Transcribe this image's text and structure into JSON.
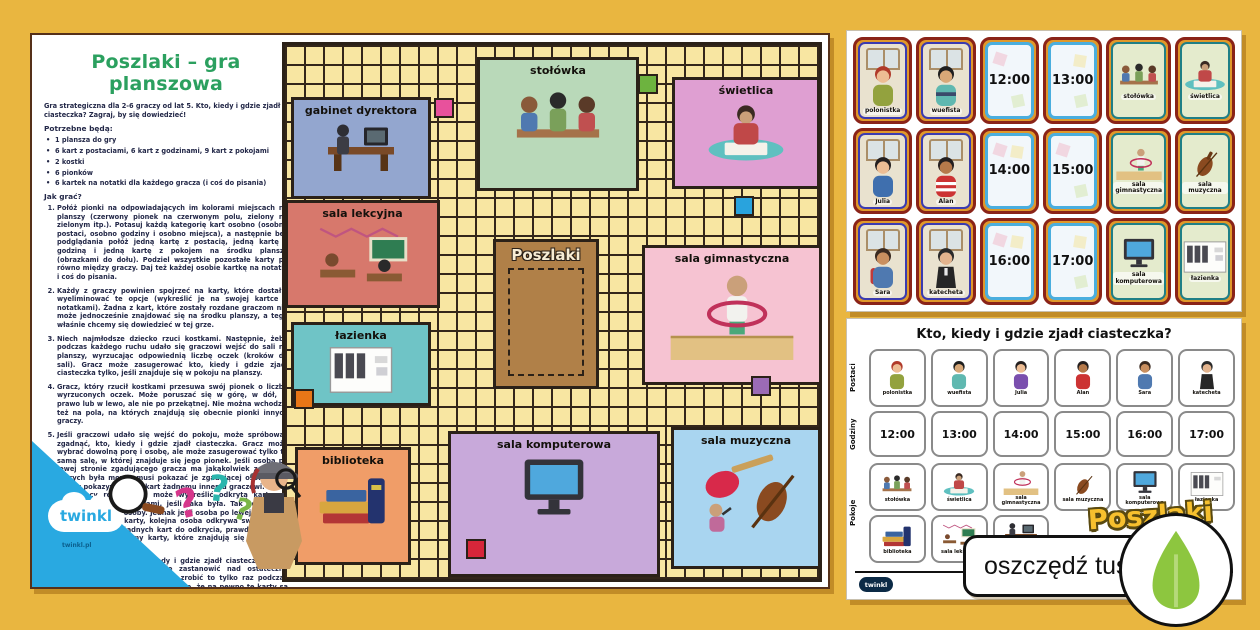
{
  "background_color": "#e9b640",
  "brand": {
    "logo": "twinkl",
    "site": "twinkl.pl"
  },
  "instructions": {
    "title": "Poszlaki – gra planszowa",
    "title_color": "#2ba05f",
    "intro": "Gra strategiczna dla 2-6 graczy od lat 5. Kto, kiedy i gdzie zjadł ciasteczka? Zagraj, by się dowiedzieć!",
    "needed_heading": "Potrzebne będą:",
    "needed_items": [
      "1 plansza do gry",
      "6 kart z postaciami, 6 kart z godzinami, 9 kart z pokojami",
      "2 kostki",
      "6 pionków",
      "6 kartek na notatki dla każdego gracza (i coś do pisania)"
    ],
    "howto_heading": "Jak grać?",
    "steps": [
      "Połóż pionki na odpowiadających im kolorami miejscach na planszy (czerwony pionek na czerwonym polu, zielony na zielonym itp.). Potasuj każdą kategorię kart osobno (osobno postaci, osobno godziny i osobno miejsca), a następnie bez podglądania połóż jedną kartę z postacią, jedną kartę z godziną i jedną kartę z pokojem na środku planszy (obrazkami do dołu). Podziel wszystkie pozostałe karty po równo między graczy. Daj też każdej osobie kartkę na notatki i coś do pisania.",
      "Każdy z graczy powinien spojrzeć na karty, które dostał i wyeliminować te opcje (wykreślić je na swojej kartce z notatkami). Żadna z kart, które zostały rozdane graczom nie może jednocześnie znajdować się na środku planszy, a tego właśnie chcemy się dowiedzieć w tej grze.",
      "Niech najmłodsze dziecko rzuci kostkami. Następnie, żeby podczas każdego ruchu udało się graczowi wejść do sali na planszy, wyrzucając odpowiednią liczbę oczek (kroków do sali). Gracz może zasugerować kto, kiedy i gdzie zjadł ciasteczka tylko, jeśli znajduje się w pokoju na planszy.",
      "Gracz, który rzucił kostkami przesuwa swój pionek o liczbę wyrzuconych oczek. Może poruszać się w górę, w dół, w prawo lub w lewo, ale nie po przekątnej. Nie można wchodzić też na pola, na których znajdują się obecnie pionki innych graczy.",
      "Jeśli graczowi udało się wejść do pokoju, może spróbować zgadnąć, kto, kiedy i gdzie zjadł ciasteczka. Gracz może wybrać dowolną porę i osobę, ale może zasugerować tylko tę samą salę, w której znajduje się jego pionek. Jeśli osoba po lewej stronie zgadującego gracza ma jakąkolwiek z kart, o których była mowa, musi pokazać je zgadującej osobie. Nie należy pokazywać tych kart żadnemu innemu graczowi. Gracz sugerujący rozwiązanie może wykreślić odkrytą kartę na swojej kartce z notatkami, jeśli taka była. Tak kończy się kolejka pierwszej osoby. Jednak jeśli osoba po lewej nie miała żadnej pasującej karty, kolejna osoba odkrywa swoje karty. Jeśli nikt nie ma żadnych kart do odkrycia, prawdopodobnie poprawnie odgadliśmy karty, które znajdują się na środku planszy.",
      "Można sugerować, kto, kiedy i gdzie zjadł ciasteczka wiele razy, ale trzeba bardzo się zastanowić nad ostateczną zagadką (oskarżeniem). Można zrobić to tylko raz podczas całej rozgrywki. Należy upewnić się, że na pewno te karty są na środku planszy, bez zgadywania. Jeśli ktoś zdecyduje się na wysunięcie ostatecznego oskarżenia, sprawdza on karty na środku planszy w taki sposób, żeby nikt inny nie mógł ich podejrzeć. Jeśli wszystkie trzy karty zgadzają się z oskarżeniem, mamy zwycięzcę! Jednak jeśli nie udało się zgadnąć choć jednej karty, niestety tym razem nie udało nam się wygrać i nie wolno nam już kontynuować gry. Reszta graczy kontynuuje grę."
    ]
  },
  "board": {
    "center_label": "Poszlaki",
    "rooms": [
      {
        "label": "gabinet dyrektora",
        "color": "#93a6cf"
      },
      {
        "label": "stołówka",
        "color": "#b9d9b9"
      },
      {
        "label": "świetlica",
        "color": "#df9fd2"
      },
      {
        "label": "sala lekcyjna",
        "color": "#d7786c"
      },
      {
        "label": "sala gimnastyczna",
        "color": "#f6c3d2"
      },
      {
        "label": "łazienka",
        "color": "#6fc4c6"
      },
      {
        "label": "biblioteka",
        "color": "#f09d68"
      },
      {
        "label": "sala komputerowa",
        "color": "#c8a9da"
      },
      {
        "label": "sala muzyczna",
        "color": "#a9d5f0"
      }
    ],
    "start_colors": [
      "#e8519c",
      "#6db33f",
      "#29a3dd",
      "#9b6bb5",
      "#e87617",
      "#d7263a"
    ]
  },
  "cards": {
    "rows": [
      [
        {
          "type": "person",
          "label": "polonistka"
        },
        {
          "type": "person",
          "label": "wuefista"
        },
        {
          "type": "time",
          "label": "12:00"
        },
        {
          "type": "time",
          "label": "13:00"
        },
        {
          "type": "room",
          "label": "stołówka"
        },
        {
          "type": "room",
          "label": "świetlica"
        }
      ],
      [
        {
          "type": "person",
          "label": "Julia"
        },
        {
          "type": "person",
          "label": "Alan"
        },
        {
          "type": "time",
          "label": "14:00"
        },
        {
          "type": "time",
          "label": "15:00"
        },
        {
          "type": "room",
          "label": "sala gimnastyczna"
        },
        {
          "type": "room",
          "label": "sala muzyczna"
        }
      ],
      [
        {
          "type": "person",
          "label": "Sara"
        },
        {
          "type": "person",
          "label": "katecheta"
        },
        {
          "type": "time",
          "label": "16:00"
        },
        {
          "type": "time",
          "label": "17:00"
        },
        {
          "type": "room",
          "label": "sala komputerowa"
        },
        {
          "type": "room",
          "label": "łazienka"
        }
      ]
    ]
  },
  "worksheet": {
    "title": "Kto, kiedy i gdzie zjadł ciasteczka?",
    "row_labels": [
      "Postaci",
      "Godziny",
      "Pokoje"
    ],
    "postaci": [
      "polonistka",
      "wuefista",
      "Julia",
      "Alan",
      "Sara",
      "katecheta"
    ],
    "godziny": [
      "12:00",
      "13:00",
      "14:00",
      "15:00",
      "16:00",
      "17:00"
    ],
    "pokoje": [
      "stołówka",
      "świetlica",
      "sala gimnastyczna",
      "sala muzyczna",
      "sala komputerowa",
      "łazienka",
      "biblioteka",
      "sala lekcyjna",
      "gabinet dyrektora"
    ],
    "logo_text": "Poszlaki"
  },
  "badge": {
    "label": "oszczędź tusz",
    "leaf_color": "#8dc63f"
  }
}
